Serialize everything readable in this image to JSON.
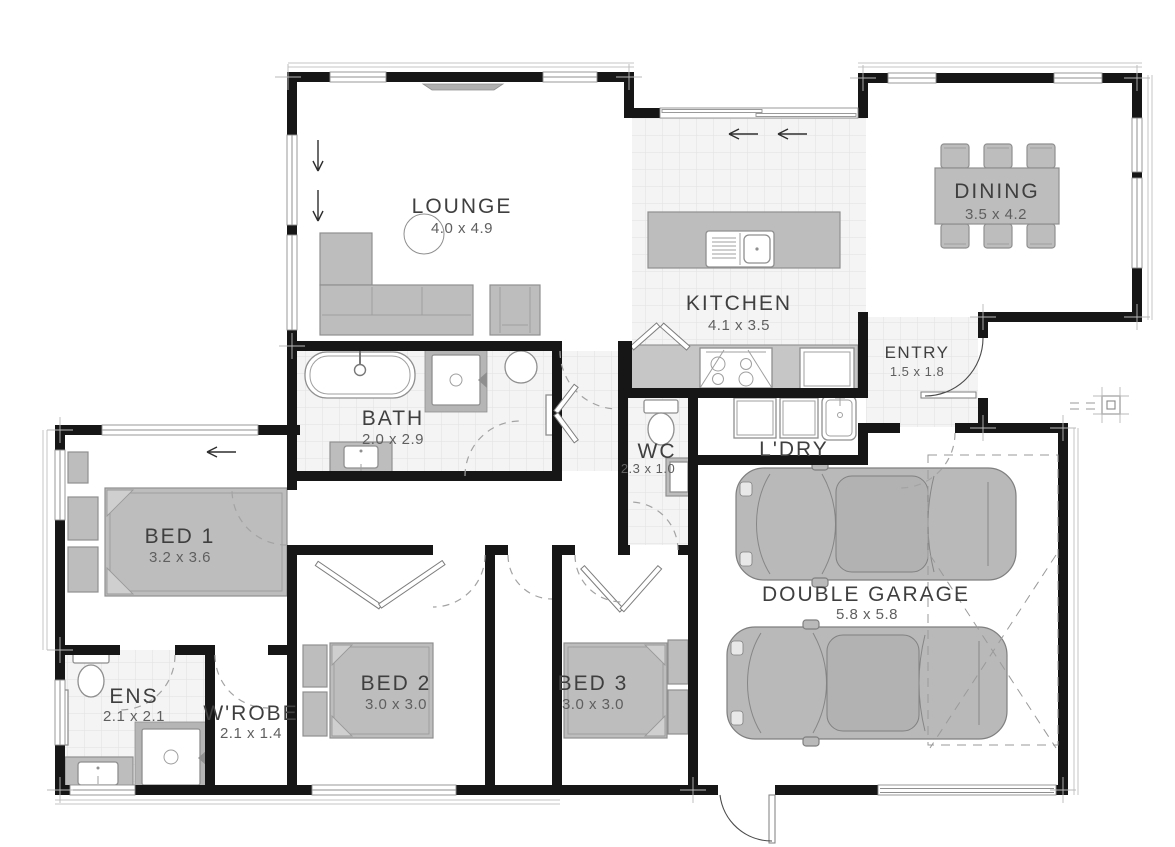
{
  "plan": {
    "rooms": [
      {
        "id": "lounge",
        "name": "LOUNGE",
        "dims": "4.0 x 4.9"
      },
      {
        "id": "kitchen",
        "name": "KITCHEN",
        "dims": "4.1 x 3.5"
      },
      {
        "id": "dining",
        "name": "DINING",
        "dims": "3.5 x 4.2"
      },
      {
        "id": "entry",
        "name": "ENTRY",
        "dims": "1.5 x 1.8"
      },
      {
        "id": "bath",
        "name": "BATH",
        "dims": "2.0 x 2.9"
      },
      {
        "id": "wc",
        "name": "WC",
        "dims": "2.3 x 1.0"
      },
      {
        "id": "ldry",
        "name": "L'DRY",
        "dims": ""
      },
      {
        "id": "bed1",
        "name": "BED 1",
        "dims": "3.2 x 3.6"
      },
      {
        "id": "ens",
        "name": "ENS",
        "dims": "2.1 x 2.1"
      },
      {
        "id": "wrobe",
        "name": "W'ROBE",
        "dims": "2.1 x 1.4"
      },
      {
        "id": "bed2",
        "name": "BED 2",
        "dims": "3.0 x 3.0"
      },
      {
        "id": "bed3",
        "name": "BED 3",
        "dims": "3.0 x 3.0"
      },
      {
        "id": "garage",
        "name": "DOUBLE GARAGE",
        "dims": "5.8 x 5.8"
      }
    ],
    "colors": {
      "wall": "#161616",
      "furniture": "#bdbdbd",
      "furniture_outline": "#8f8f8f",
      "bench": "#c6c6c6",
      "tile_bg": "#f4f4f4",
      "tile_line": "#e1e1e1",
      "room_text": "#3f3f3f",
      "dim_text": "#5f5f5f",
      "car_body": "#b9b9b9",
      "dash": "#9a9a9a",
      "arc": "#4a4a4a",
      "window_line": "#8f8f8f"
    }
  }
}
